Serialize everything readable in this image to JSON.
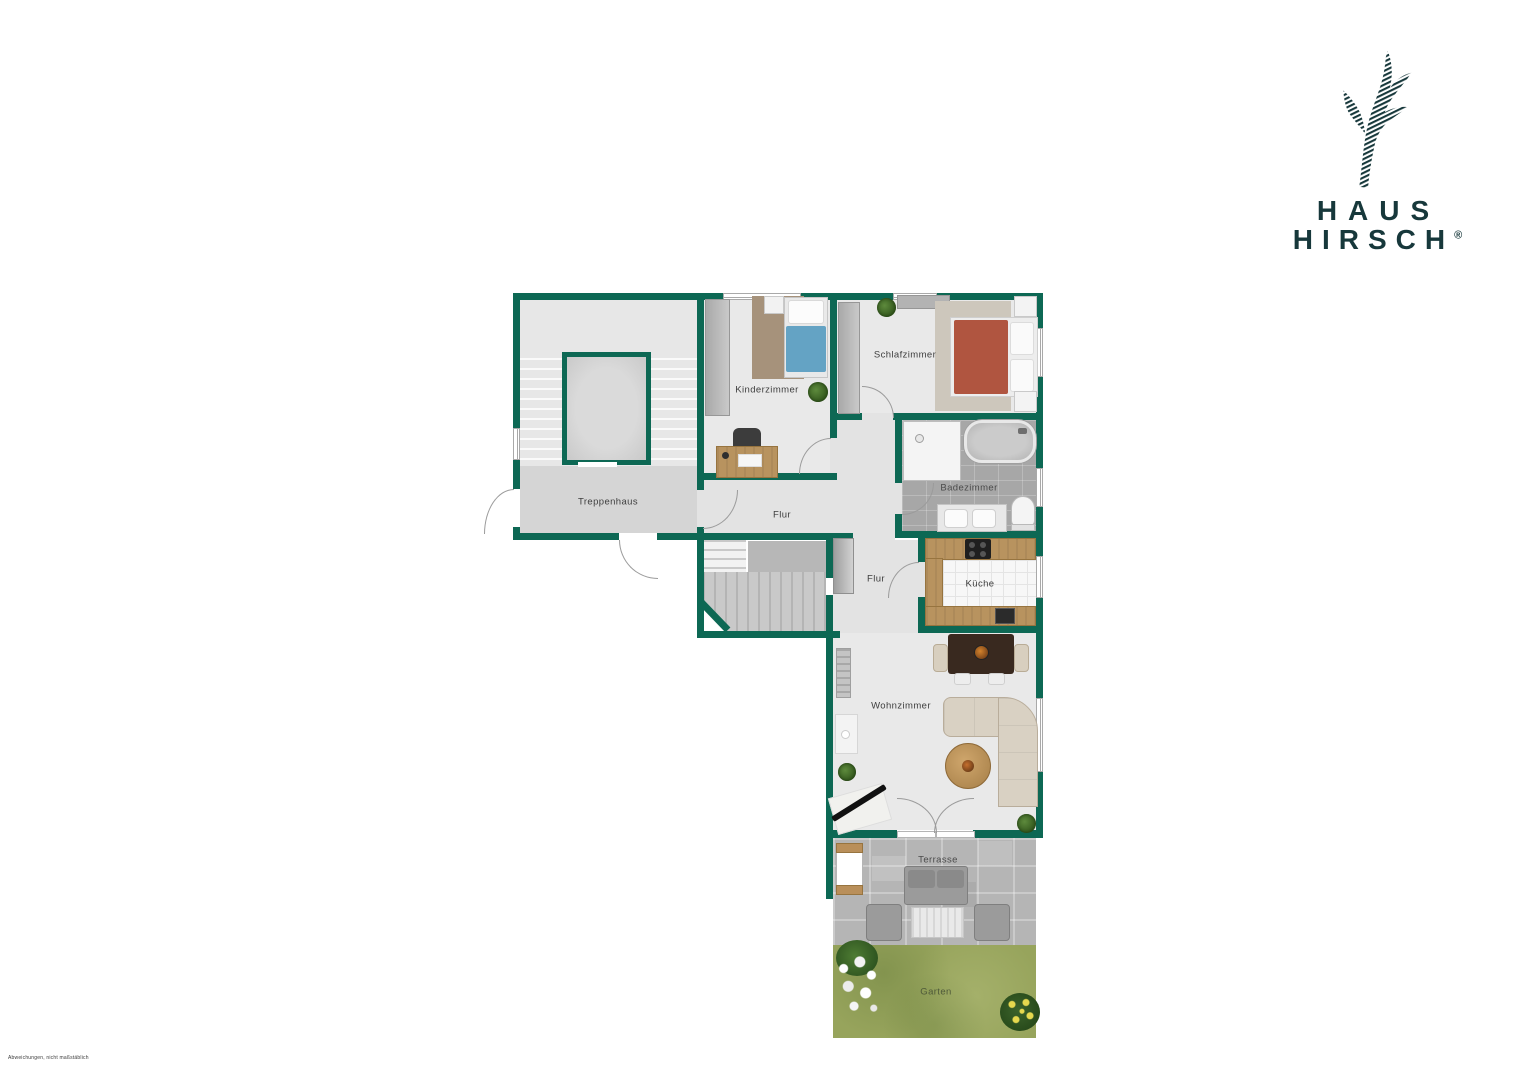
{
  "brand": {
    "name_line1": "HAUS",
    "name_line2": "HIRSCH",
    "registered": "®"
  },
  "plan": {
    "rooms": [
      {
        "id": "treppenhaus",
        "label": "Treppenhaus"
      },
      {
        "id": "kinderzimmer",
        "label": "Kinderzimmer"
      },
      {
        "id": "schlafzimmer",
        "label": "Schlafzimmer"
      },
      {
        "id": "flur_oben",
        "label": "Flur"
      },
      {
        "id": "badezimmer",
        "label": "Badezimmer"
      },
      {
        "id": "flur_mitte",
        "label": "Flur"
      },
      {
        "id": "kueche",
        "label": "Küche"
      },
      {
        "id": "wohnzimmer",
        "label": "Wohnzimmer"
      },
      {
        "id": "terrasse",
        "label": "Terrasse"
      },
      {
        "id": "garten",
        "label": "Garten"
      }
    ]
  },
  "footer": {
    "disclaimer": "Abweichungen, nicht maßstäblich"
  },
  "colors": {
    "wall": "#0d6854",
    "logo": "#17383b",
    "grass": "#97a45c",
    "wood": "#b8935f",
    "bed_blue": "#64a3c4",
    "bed_red": "#b05540"
  }
}
